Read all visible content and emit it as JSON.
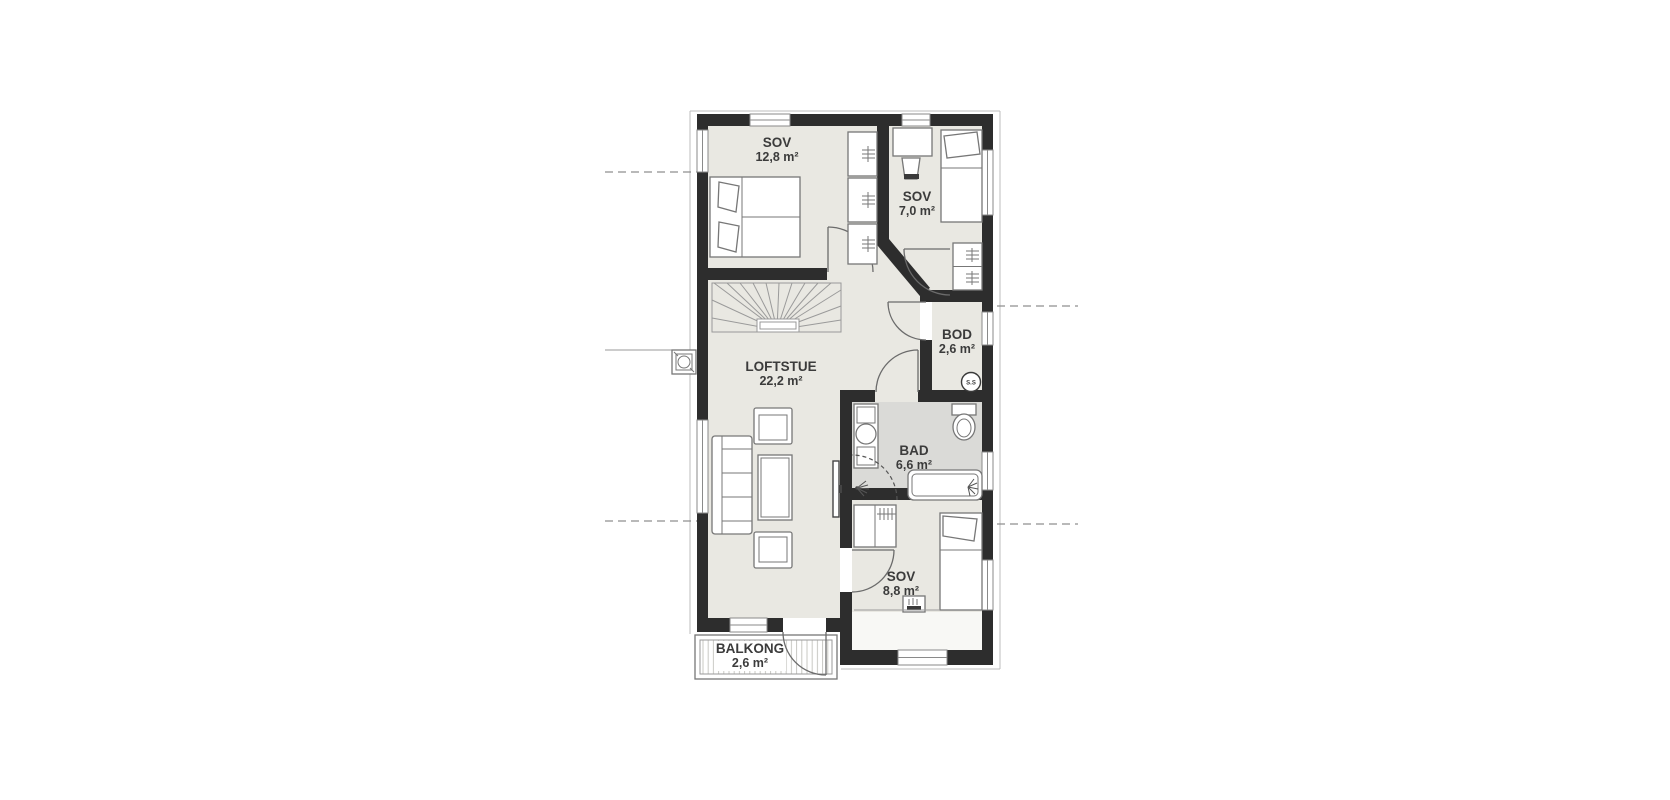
{
  "plan": {
    "rooms": [
      {
        "name": "SOV",
        "area": "12,8 m²"
      },
      {
        "name": "SOV",
        "area": "7,0 m²"
      },
      {
        "name": "BOD",
        "area": "2,6 m²"
      },
      {
        "name": "BAD",
        "area": "6,6 m²"
      },
      {
        "name": "LOFTSTUE",
        "area": "22,2 m²"
      },
      {
        "name": "SOV",
        "area": "8,8 m²"
      },
      {
        "name": "BALKONG",
        "area": "2,6 m²"
      }
    ],
    "shaft_badge": "S.S",
    "colors": {
      "wall": "#2d2d2d",
      "floor": "#e9e8e2",
      "bath_floor": "#dadad7",
      "deck_stripe": "#c8c8c3",
      "symbol_stroke": "#777777",
      "text": "#3b3b3b",
      "reference_line": "#8f8f8f",
      "background": "#ffffff"
    }
  }
}
